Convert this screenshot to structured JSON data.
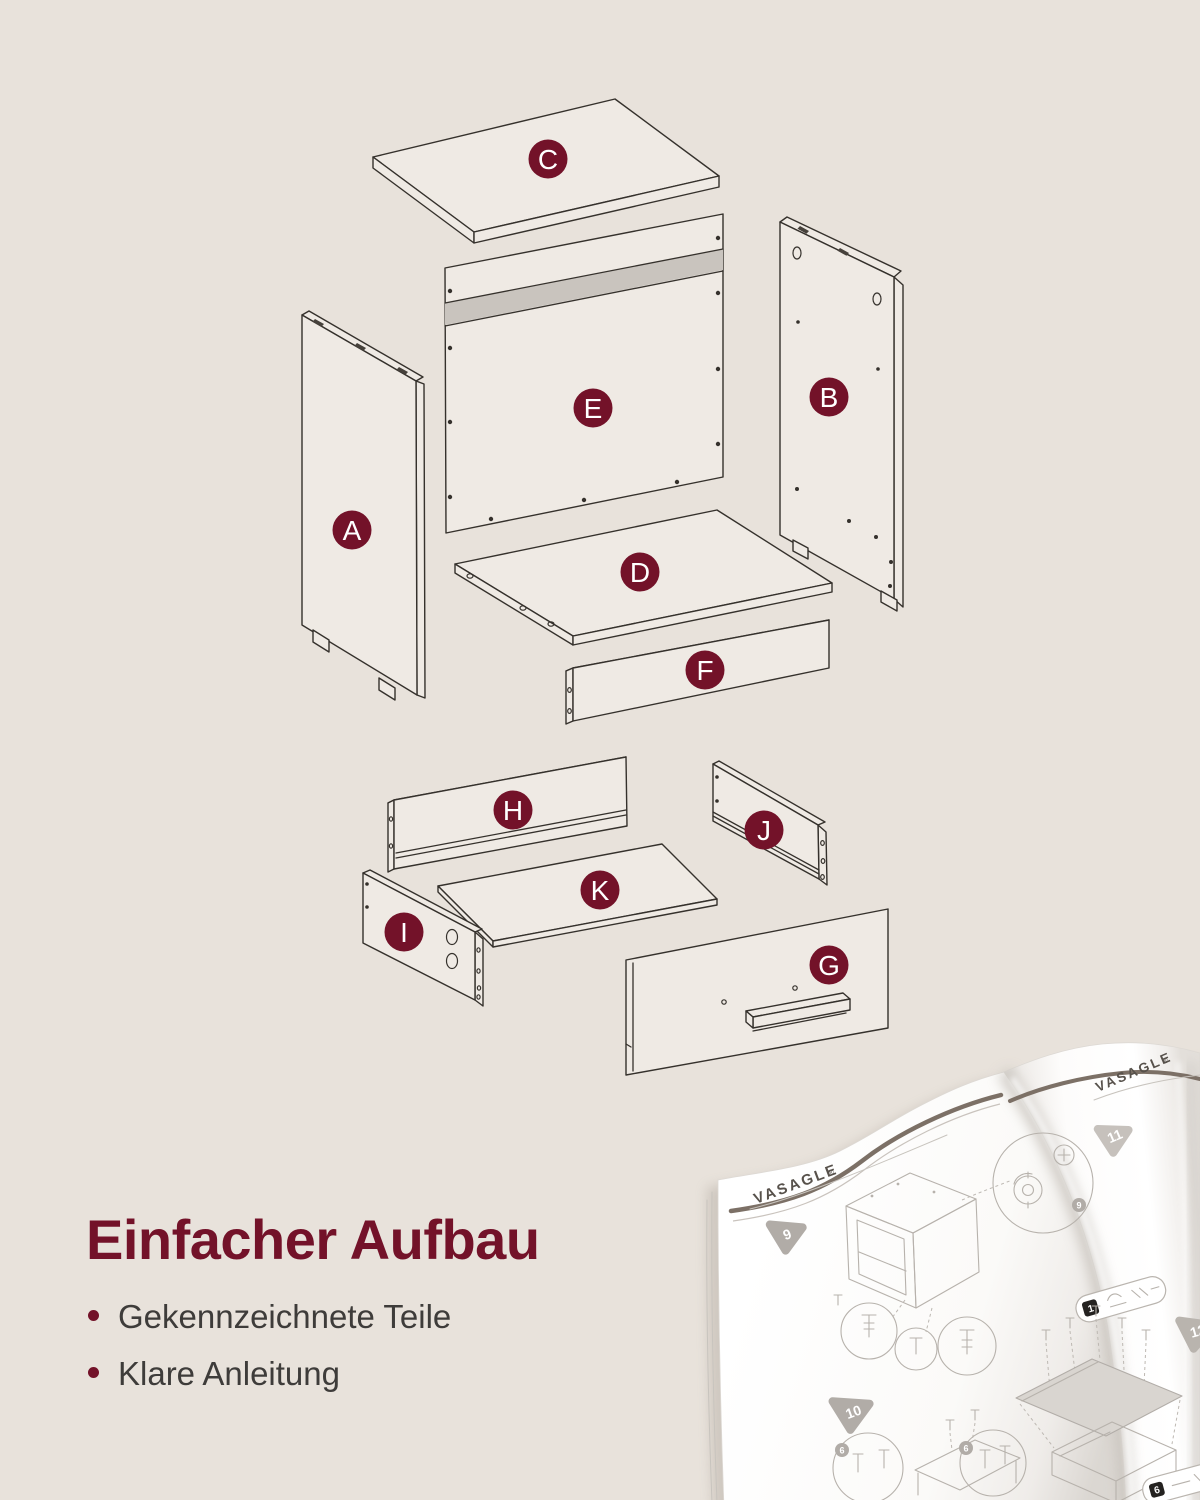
{
  "page": {
    "background": "#E8E2DB"
  },
  "colors": {
    "accent_maroon": "#731229",
    "panel_fill": "#EFEAE4",
    "outline": "#35312C",
    "groove_gray": "#C9C4BE",
    "body_text": "#3E3C3A",
    "manual_line_gray": "#B7B2AC",
    "manual_brown": "#7C7066"
  },
  "diagram": {
    "badges": [
      {
        "letter": "C"
      },
      {
        "letter": "E"
      },
      {
        "letter": "B"
      },
      {
        "letter": "A"
      },
      {
        "letter": "D"
      },
      {
        "letter": "F"
      },
      {
        "letter": "H"
      },
      {
        "letter": "J"
      },
      {
        "letter": "K"
      },
      {
        "letter": "I"
      },
      {
        "letter": "G"
      }
    ]
  },
  "caption": {
    "heading": "Einfacher Aufbau",
    "bullets": [
      {
        "text": "Gekennzeichnete Teile"
      },
      {
        "text": "Klare Anleitung"
      }
    ]
  },
  "manual": {
    "brand": "VASAGLE",
    "brand_mark": "®",
    "steps": [
      {
        "num": "9"
      },
      {
        "num": "10"
      },
      {
        "num": "11"
      },
      {
        "num": "12"
      }
    ],
    "hardware": [
      {
        "num": "1"
      },
      {
        "num": "6"
      }
    ],
    "detail_badges": [
      {
        "num": "9"
      },
      {
        "num": "6"
      },
      {
        "num": "6"
      }
    ]
  }
}
